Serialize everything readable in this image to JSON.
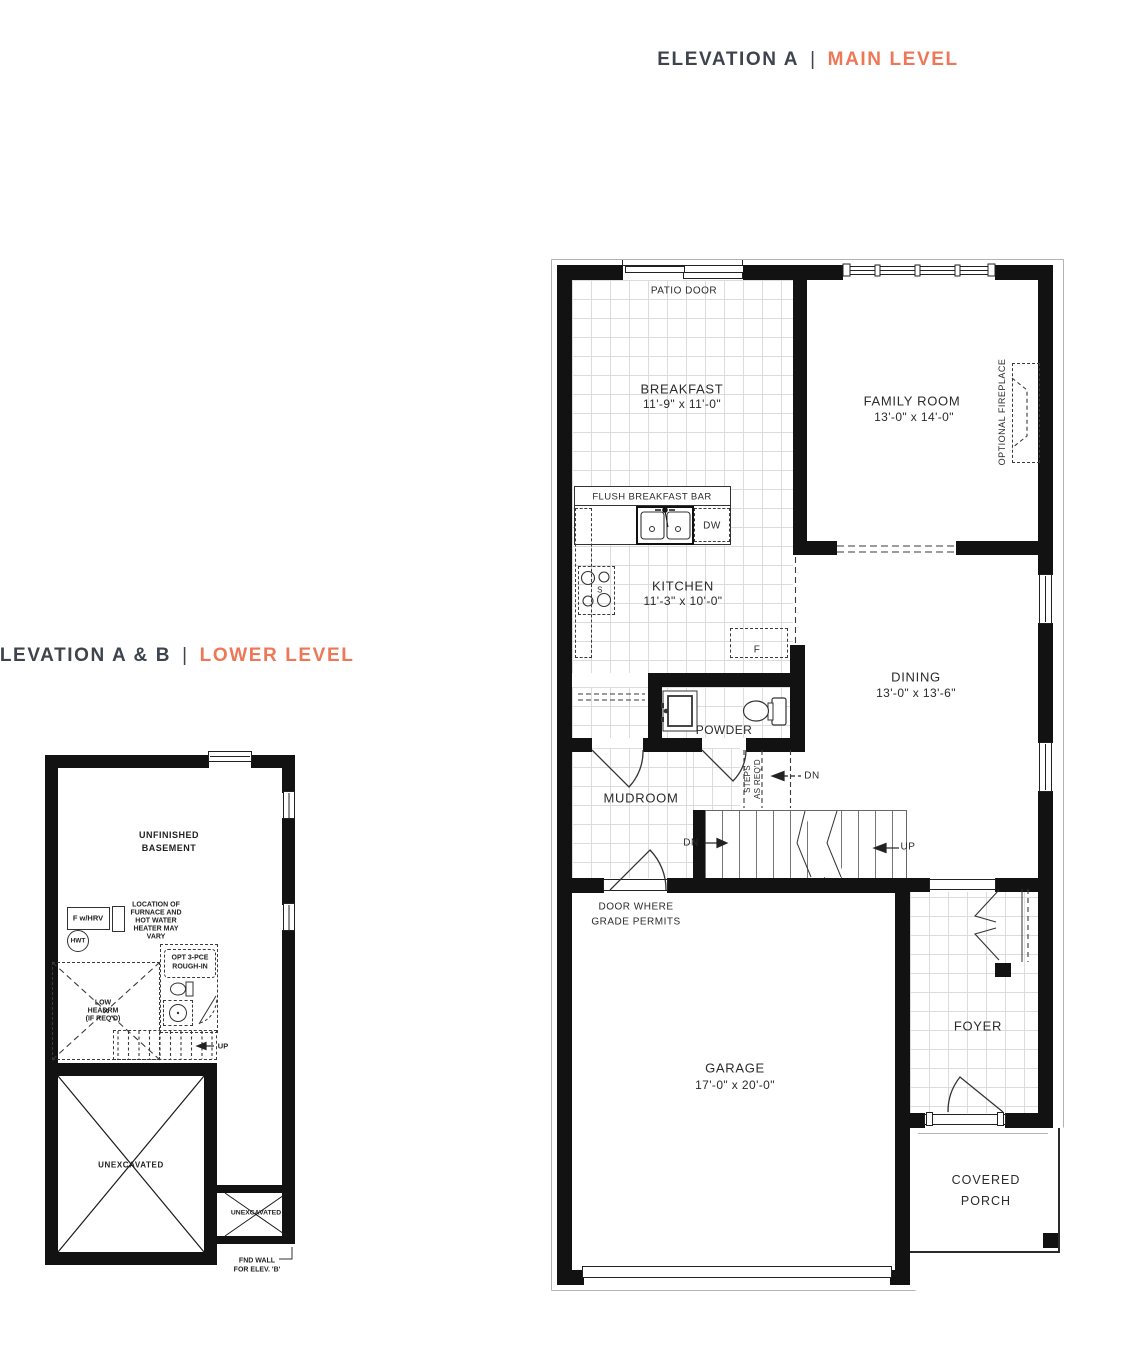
{
  "palette": {
    "wall": "#121212",
    "accent_orange": "#EE7757",
    "header_dark": "#3E444D",
    "tile_line": "#DCDCDC",
    "linework": "#333333"
  },
  "headers": {
    "main": {
      "prefix": "ELEVATION A",
      "divider": "|",
      "label": "MAIN LEVEL"
    },
    "lower": {
      "prefix": "ELEVATION A & B",
      "divider": "|",
      "label": "LOWER LEVEL"
    }
  },
  "main_level": {
    "patio_door": "PATIO DOOR",
    "breakfast": {
      "name": "BREAKFAST",
      "dims": "11'-9\" x 11'-0\""
    },
    "family_room": {
      "name": "FAMILY ROOM",
      "dims": "13'-0\" x 14'-0\""
    },
    "optional_fireplace": "OPTIONAL FIREPLACE",
    "flush_breakfast_bar": "FLUSH BREAKFAST BAR",
    "dishwasher": "DW",
    "stove_s": "S",
    "fridge_f": "F",
    "kitchen": {
      "name": "KITCHEN",
      "dims": "11'-3\" x 10'-0\""
    },
    "dining": {
      "name": "DINING",
      "dims": "13'-0\" x 13'-6\""
    },
    "powder": "POWDER",
    "mudroom": "MUDROOM",
    "steps": {
      "line1": "STEPS",
      "line2": "AS REQ'D"
    },
    "dn": "DN",
    "up": "UP",
    "door_grade": {
      "line1": "DOOR WHERE",
      "line2": "GRADE PERMITS"
    },
    "garage": {
      "name": "GARAGE",
      "dims": "17'-0\" x 20'-0\""
    },
    "foyer": "FOYER",
    "covered_porch": {
      "line1": "COVERED",
      "line2": "PORCH"
    }
  },
  "lower_level": {
    "unfinished": {
      "line1": "UNFINISHED",
      "line2": "BASEMENT"
    },
    "furnace_box": "F w/HRV",
    "hwt": "HWT",
    "furnace_note": [
      "LOCATION OF",
      "FURNACE AND",
      "HOT WATER",
      "HEATER MAY",
      "VARY"
    ],
    "rough_in": {
      "line1": "OPT 3-PCE",
      "line2": "ROUGH-IN"
    },
    "low_headrm": [
      "LOW",
      "HEADRM",
      "(IF REQ'D)"
    ],
    "up": "UP",
    "unexcavated_large": "UNEXCAVATED",
    "unexcavated_small": "UNEXCAVATED",
    "end_wall": {
      "line1": "FND WALL",
      "line2": "FOR ELEV. 'B'"
    }
  }
}
